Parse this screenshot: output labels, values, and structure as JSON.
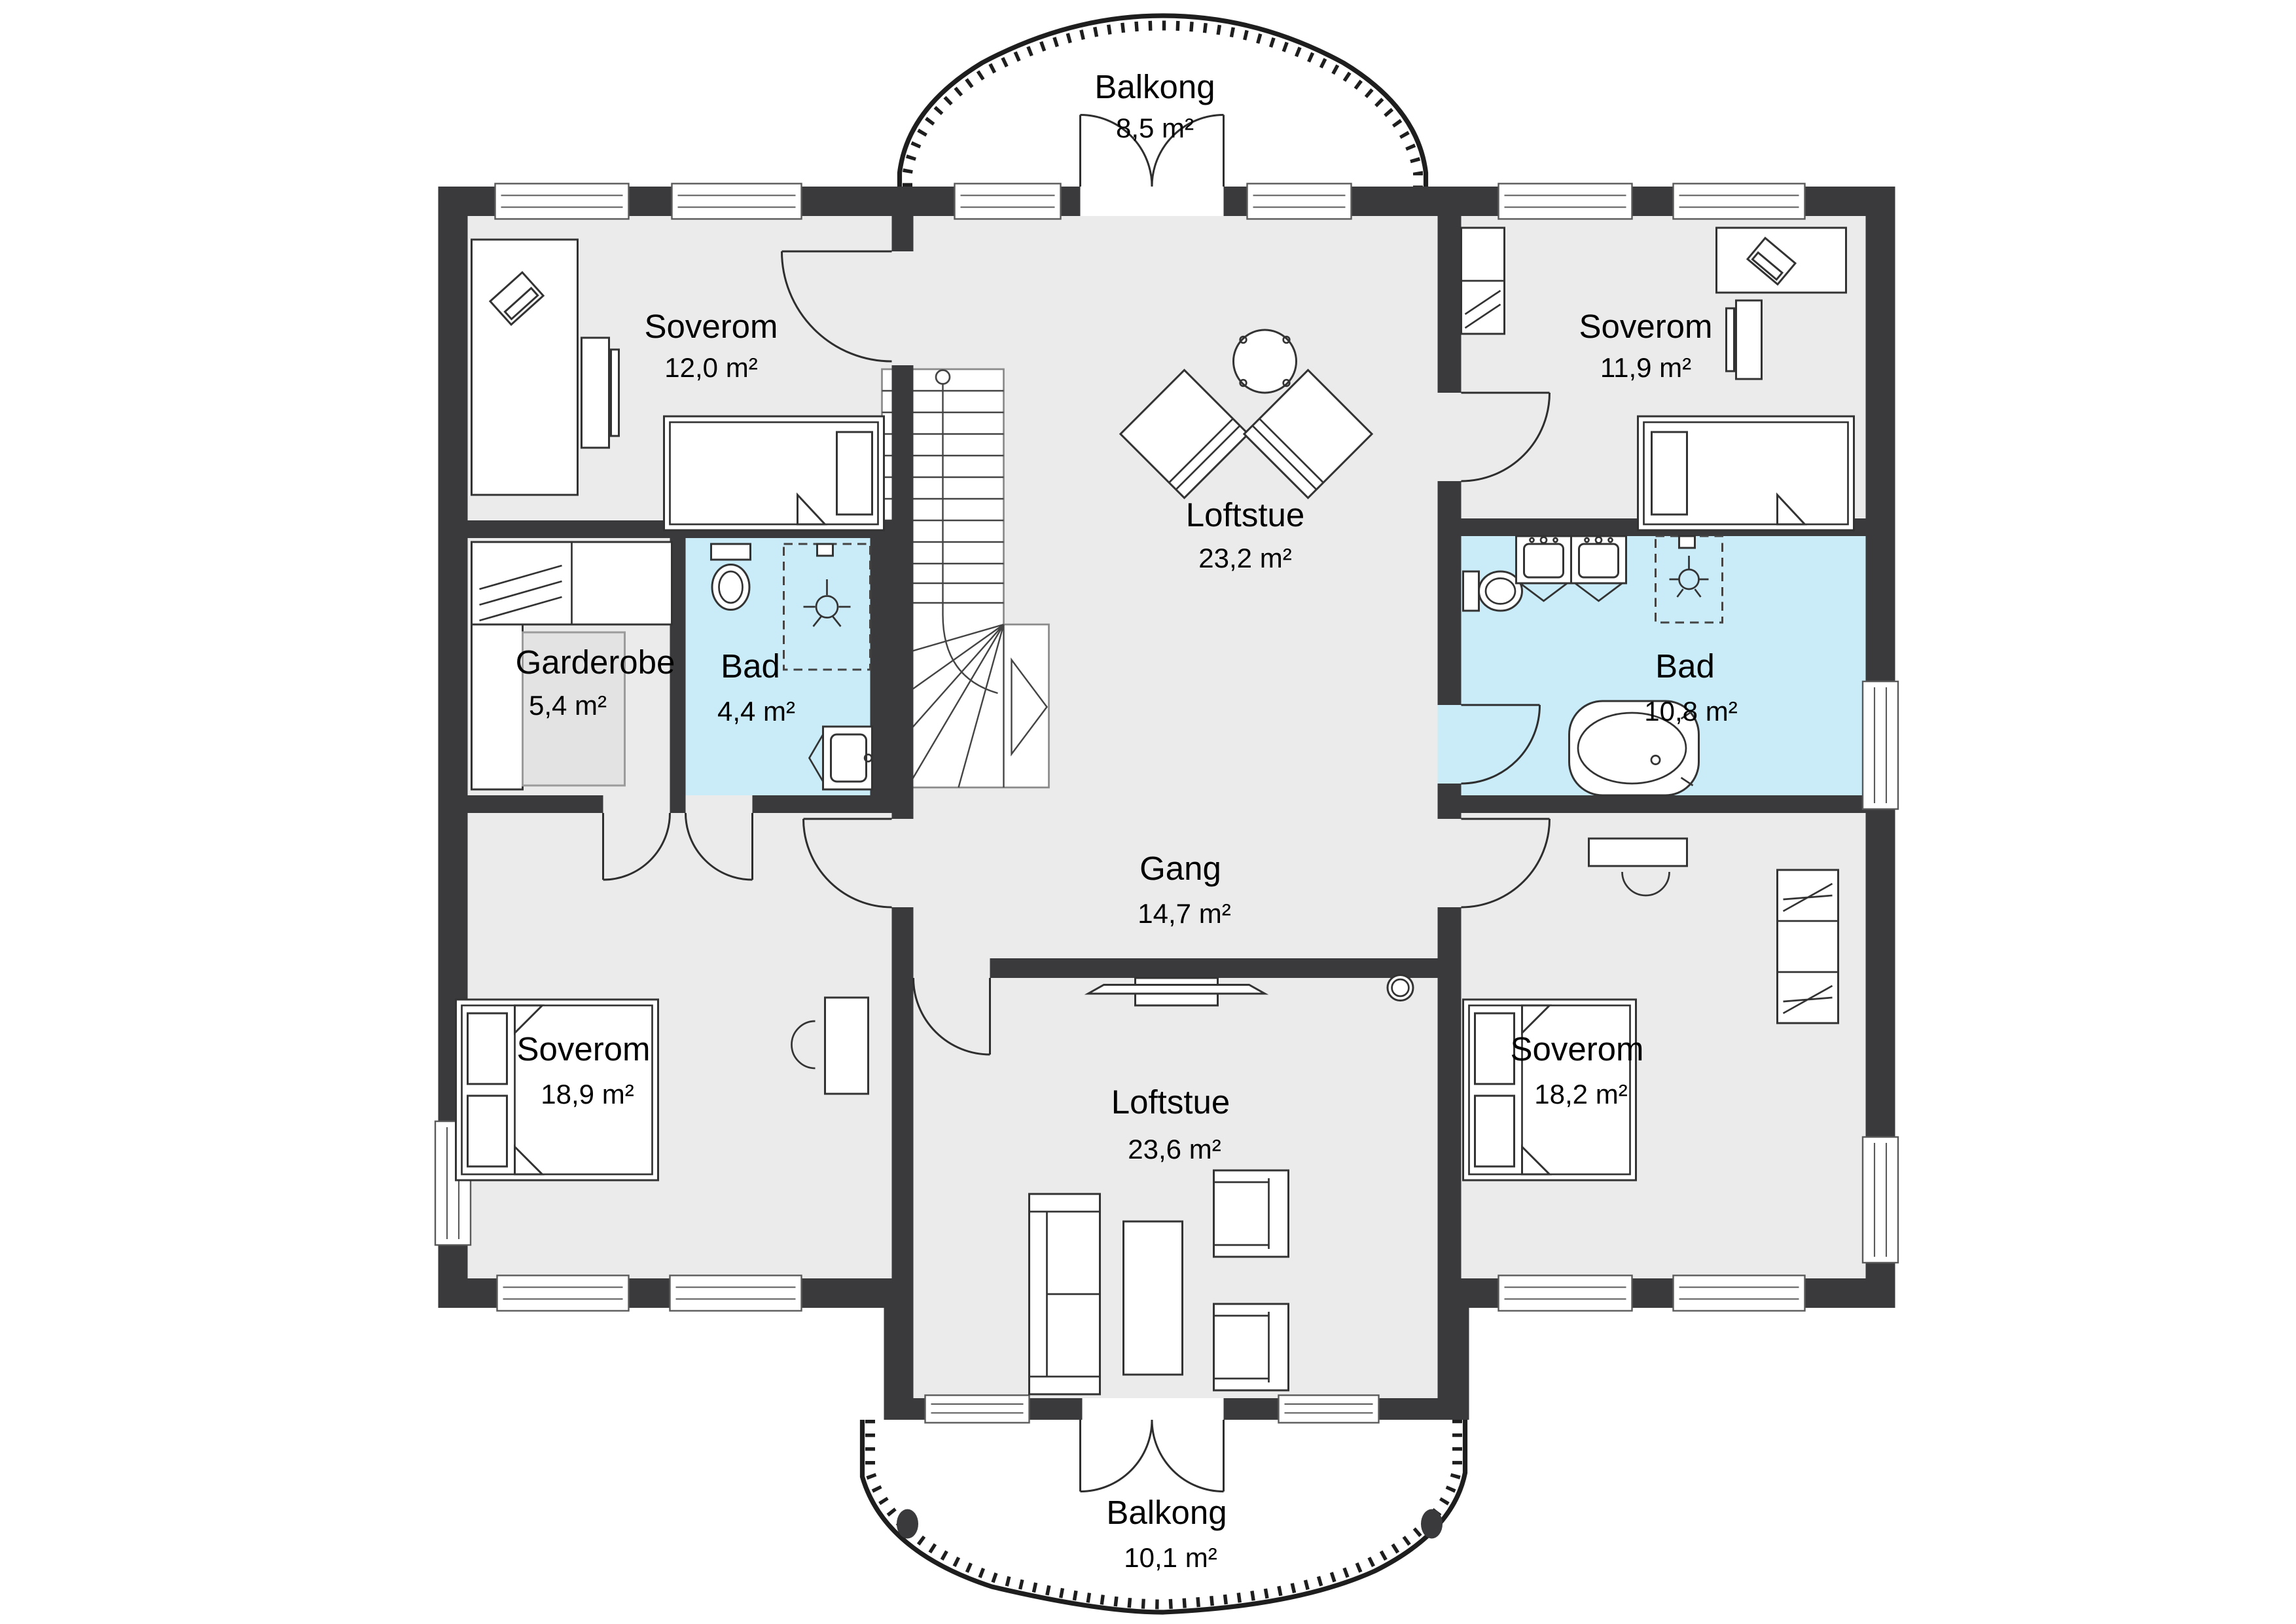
{
  "rooms": [
    {
      "id": "balkong-top",
      "name": "Balkong",
      "area": "8,5 m²"
    },
    {
      "id": "soverom-top-left",
      "name": "Soverom",
      "area": "12,0 m²"
    },
    {
      "id": "soverom-top-right",
      "name": "Soverom",
      "area": "11,9 m²"
    },
    {
      "id": "loftstue-top",
      "name": "Loftstue",
      "area": "23,2 m²"
    },
    {
      "id": "garderobe",
      "name": "Garderobe",
      "area": "5,4 m²"
    },
    {
      "id": "bad-small",
      "name": "Bad",
      "area": "4,4 m²"
    },
    {
      "id": "bad-large",
      "name": "Bad",
      "area": "10,8 m²"
    },
    {
      "id": "gang",
      "name": "Gang",
      "area": "14,7 m²"
    },
    {
      "id": "soverom-bottom-left",
      "name": "Soverom",
      "area": "18,9 m²"
    },
    {
      "id": "loftstue-bottom",
      "name": "Loftstue",
      "area": "23,6 m²"
    },
    {
      "id": "soverom-bottom-right",
      "name": "Soverom",
      "area": "18,2 m²"
    },
    {
      "id": "balkong-bottom",
      "name": "Balkong",
      "area": "10,1 m²"
    }
  ],
  "colors": {
    "wall": "#3a3a3c",
    "floor": "#ebebeb",
    "bath": "#c9ecf8"
  }
}
